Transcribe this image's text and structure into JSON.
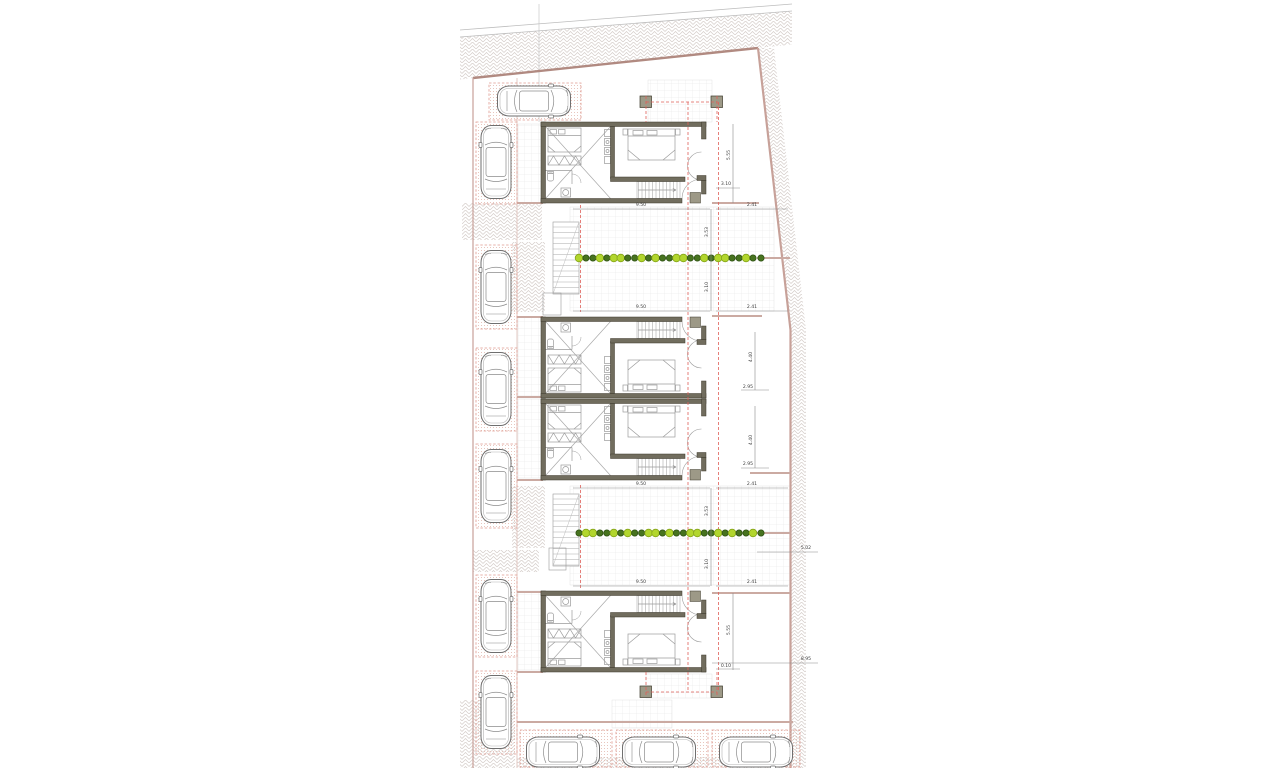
{
  "meta": {
    "title": "Architectural site plan - row of four dwellings with parking",
    "canvas": {
      "w": 1280,
      "h": 768
    }
  },
  "colors": {
    "wall": "#716d5e",
    "wall_edge": "#3c392b",
    "pier": "#9d9987",
    "boundary": "#c7a199",
    "boundary_dark": "#b18a81",
    "bay_dash": "#e09a90",
    "red_dash": "#e0605a",
    "fence": "#cbaaa2",
    "dim_line": "#8a8a8a",
    "dim_text": "#3d3d3d",
    "furniture": "#9b9b9b",
    "car_stroke": "#6f6f6f",
    "tree_light": "#b2d62d",
    "tree_light_edge": "#86a51a",
    "tree_dark": "#47731f",
    "tree_dark_edge": "#2f5214",
    "hatch": "#d3cbc7",
    "grid": "#e3e3e3",
    "dots": "#e2b9ae",
    "construction": "#c9c9c9"
  },
  "site": {
    "top_lines": [
      [
        460,
        30,
        792,
        4
      ],
      [
        460,
        37,
        792,
        11
      ]
    ],
    "top_hatch_poly": "460,37 792,11 792,44.5 758,48 473,78 460,79.5",
    "boundary_top": [
      473,
      78,
      758,
      48
    ],
    "boundary_right": "758,48 790.5,330 790.5,768",
    "boundary_left": [
      473,
      78,
      473,
      768
    ],
    "aisle_line": [
      517,
      78,
      517,
      768
    ],
    "right_strip_poly": "758,48 790.5,330 790.5,768 806,768 806,330 774,48",
    "construction_line": [
      539,
      4,
      539,
      122
    ],
    "hatch_rects": [
      [
        462,
        203,
        80,
        37
      ],
      [
        512,
        242,
        33,
        70
      ],
      [
        512,
        486,
        33,
        62
      ],
      [
        473,
        550,
        66,
        22
      ],
      [
        460,
        700,
        55,
        68
      ],
      [
        517,
        757,
        276,
        11
      ]
    ],
    "grid_rects": [
      [
        648,
        80,
        64,
        42
      ],
      [
        570,
        207,
        204,
        104
      ],
      [
        570,
        486,
        220,
        99
      ],
      [
        612,
        700,
        60,
        28
      ],
      [
        646,
        674,
        66,
        24
      ],
      [
        518,
        124,
        23,
        79
      ],
      [
        518,
        317,
        23,
        79
      ],
      [
        518,
        399,
        23,
        79
      ],
      [
        518,
        591,
        23,
        79
      ]
    ],
    "fences": [
      [
        712,
        203,
        759,
        203
      ],
      [
        757,
        258,
        790,
        258
      ],
      [
        712,
        316,
        762,
        316
      ],
      [
        750,
        473,
        790,
        473
      ],
      [
        757,
        533,
        790,
        533
      ],
      [
        712,
        593,
        790,
        593
      ],
      [
        517,
        722,
        793,
        722
      ],
      [
        517,
        203,
        543,
        203
      ],
      [
        517,
        317,
        543,
        317
      ],
      [
        517,
        397,
        543,
        397
      ],
      [
        517,
        480,
        543,
        480
      ],
      [
        517,
        592,
        543,
        592
      ],
      [
        517,
        672,
        543,
        672
      ]
    ]
  },
  "units": [
    {
      "id": "unit-1",
      "tx": 541,
      "ty": 122,
      "flip": false
    },
    {
      "id": "unit-2",
      "tx": 541,
      "ty": 398,
      "flip": true
    },
    {
      "id": "unit-3",
      "tx": 541,
      "ty": 399,
      "flip": false
    },
    {
      "id": "unit-4",
      "tx": 541,
      "ty": 672,
      "flip": true
    }
  ],
  "posts": [
    [
      640,
      96
    ],
    [
      711,
      96
    ],
    [
      640,
      686
    ],
    [
      711,
      686
    ]
  ],
  "post_size": 11.5,
  "red_dashed": [
    [
      646,
      96,
      646,
      122
    ],
    [
      717,
      96,
      717,
      122
    ],
    [
      646,
      102,
      717,
      102
    ],
    [
      646,
      672,
      646,
      697
    ],
    [
      717,
      672,
      717,
      697
    ],
    [
      646,
      692,
      717,
      692
    ],
    [
      688,
      102,
      688,
      692
    ],
    [
      718.5,
      102,
      718.5,
      692
    ],
    [
      580.5,
      205,
      580.5,
      312
    ],
    [
      580.5,
      485,
      580.5,
      588
    ]
  ],
  "parking": {
    "left_bays": [
      [
        489,
        83,
        92,
        37
      ],
      [
        476,
        122,
        41,
        82
      ],
      [
        476,
        245,
        41,
        84
      ],
      [
        476,
        348,
        41,
        83
      ],
      [
        476,
        444,
        41,
        84
      ],
      [
        476,
        575,
        41,
        82
      ],
      [
        476,
        671,
        41,
        83
      ]
    ],
    "bottom_bays": [
      [
        520,
        730,
        92,
        37
      ],
      [
        616,
        730,
        92,
        37
      ],
      [
        712,
        730,
        88,
        37
      ]
    ],
    "cars": [
      {
        "x": 534,
        "y": 101,
        "r": 90
      },
      {
        "x": 496,
        "y": 162,
        "r": 0
      },
      {
        "x": 496,
        "y": 287,
        "r": 0
      },
      {
        "x": 496,
        "y": 389,
        "r": 0
      },
      {
        "x": 496,
        "y": 486,
        "r": 0
      },
      {
        "x": 496,
        "y": 616,
        "r": 0
      },
      {
        "x": 496,
        "y": 712,
        "r": 0
      },
      {
        "x": 563,
        "y": 752,
        "r": 90
      },
      {
        "x": 659,
        "y": 752,
        "r": 90
      },
      {
        "x": 756,
        "y": 752,
        "r": 90
      }
    ]
  },
  "hedges": {
    "rows": [
      {
        "y": 258,
        "x0": 579,
        "x1": 753,
        "pattern": "LDDLDLLDDLDLDDLLDDLDLLDDLD"
      },
      {
        "y": 533,
        "x0": 579,
        "x1": 753,
        "pattern": "DLLDDLDLDDLLDLDDLLDDLDLDDL"
      }
    ],
    "extra": [
      {
        "x": 761,
        "y": 258,
        "t": "D"
      },
      {
        "x": 761,
        "y": 533,
        "t": "D"
      }
    ]
  },
  "ext_stairs": [
    [
      553,
      222,
      26,
      72
    ],
    [
      553,
      494,
      26,
      72
    ]
  ],
  "ext_landings": [
    [
      543,
      293,
      18,
      22
    ],
    [
      549,
      548,
      17,
      22
    ]
  ],
  "dimensions": {
    "lines": [
      [
        573,
        209,
        710,
        209
      ],
      [
        716,
        209,
        788,
        209
      ],
      [
        711,
        209,
        711,
        311
      ],
      [
        573,
        311,
        710,
        311
      ],
      [
        716,
        311,
        788,
        311
      ],
      [
        733,
        124,
        733,
        203
      ],
      [
        716,
        188,
        740,
        188
      ],
      [
        573,
        488,
        710,
        488
      ],
      [
        716,
        488,
        788,
        488
      ],
      [
        711,
        488,
        711,
        586
      ],
      [
        573,
        586,
        710,
        586
      ],
      [
        716,
        586,
        788,
        586
      ],
      [
        755,
        332,
        755,
        390
      ],
      [
        741,
        390,
        769,
        390
      ],
      [
        755,
        406,
        755,
        468
      ],
      [
        741,
        468,
        769,
        468
      ],
      [
        733,
        593,
        733,
        670
      ],
      [
        716,
        669,
        740,
        669
      ],
      [
        757,
        552,
        818,
        552
      ],
      [
        712,
        663,
        818,
        663
      ]
    ],
    "labels": [
      {
        "t": "9.50",
        "x": 641,
        "y": 206,
        "r": 0
      },
      {
        "t": "2.41",
        "x": 752,
        "y": 206,
        "r": 0
      },
      {
        "t": "3.53",
        "x": 708,
        "y": 232,
        "r": 90
      },
      {
        "t": "3.10",
        "x": 708,
        "y": 287,
        "r": 90
      },
      {
        "t": "9.50",
        "x": 641,
        "y": 308,
        "r": 0
      },
      {
        "t": "2.41",
        "x": 752,
        "y": 308,
        "r": 0
      },
      {
        "t": "5.55",
        "x": 730,
        "y": 155,
        "r": 90
      },
      {
        "t": "3.10",
        "x": 726,
        "y": 185,
        "r": 0
      },
      {
        "t": "9.50",
        "x": 641,
        "y": 485,
        "r": 0
      },
      {
        "t": "2.41",
        "x": 752,
        "y": 485,
        "r": 0
      },
      {
        "t": "3.53",
        "x": 708,
        "y": 511,
        "r": 90
      },
      {
        "t": "3.10",
        "x": 708,
        "y": 564,
        "r": 90
      },
      {
        "t": "9.50",
        "x": 641,
        "y": 583,
        "r": 0
      },
      {
        "t": "2.41",
        "x": 752,
        "y": 583,
        "r": 0
      },
      {
        "t": "4.40",
        "x": 752,
        "y": 357,
        "r": 90
      },
      {
        "t": "2.95",
        "x": 748,
        "y": 388,
        "r": 0
      },
      {
        "t": "4.40",
        "x": 752,
        "y": 440,
        "r": 90
      },
      {
        "t": "2.95",
        "x": 748,
        "y": 465,
        "r": 0
      },
      {
        "t": "5.55",
        "x": 730,
        "y": 630,
        "r": 90
      },
      {
        "t": "0.10",
        "x": 726,
        "y": 667,
        "r": 0
      },
      {
        "t": "5.02",
        "x": 806,
        "y": 549,
        "r": 0
      },
      {
        "t": "8.95",
        "x": 806,
        "y": 660,
        "r": 0
      }
    ]
  }
}
